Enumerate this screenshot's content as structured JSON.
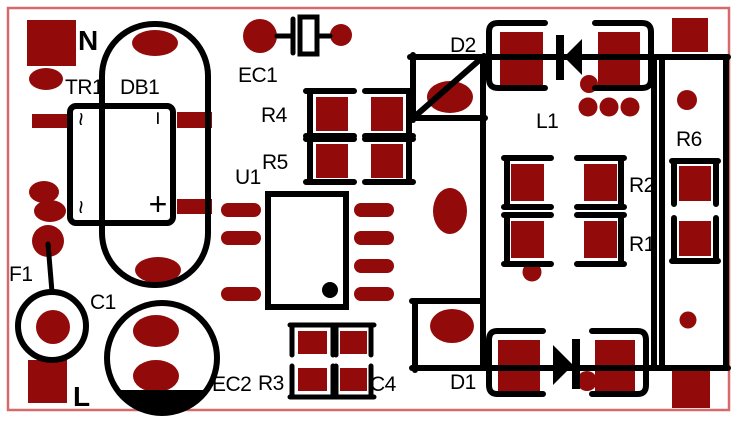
{
  "title": "PCB layout",
  "colors": {
    "background": "#ffffff",
    "pad_copper": "#930a0a",
    "silkscreen": "#000000",
    "board_outline": "#d66a6a"
  },
  "net_labels": {
    "neutral": "N",
    "line": "L"
  },
  "components": {
    "tr1": {
      "label": "TR1"
    },
    "db1": {
      "label": "DB1",
      "marks": {
        "ac_top": "~",
        "ac_bottom": "~",
        "neg": "−",
        "pos": "+"
      }
    },
    "ec1": {
      "label": "EC1"
    },
    "ec2": {
      "label": "EC2"
    },
    "f1": {
      "label": "F1"
    },
    "c1": {
      "label": "C1"
    },
    "c4": {
      "label": "C4"
    },
    "r1": {
      "label": "R1"
    },
    "r2": {
      "label": "R2"
    },
    "r3": {
      "label": "R3"
    },
    "r4": {
      "label": "R4"
    },
    "r5": {
      "label": "R5"
    },
    "r6": {
      "label": "R6"
    },
    "u1": {
      "label": "U1"
    },
    "l1": {
      "label": "L1"
    },
    "d1": {
      "label": "D1"
    },
    "d2": {
      "label": "D2"
    }
  }
}
